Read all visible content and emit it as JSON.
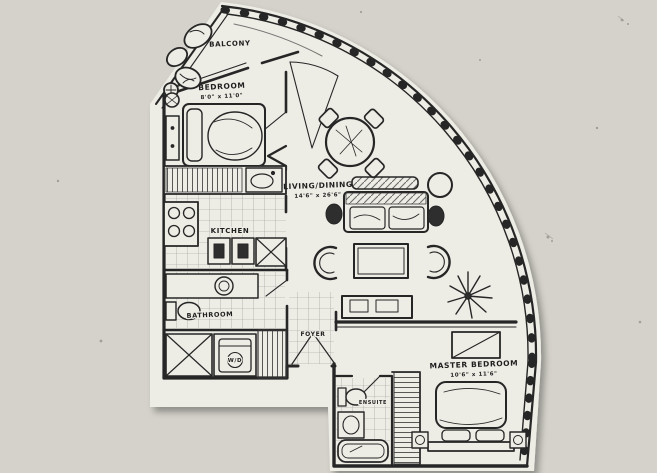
{
  "colors": {
    "background": "#d4d2ca",
    "paper": "#edece5",
    "ink": "#262626",
    "speck": "#77756c"
  },
  "plan": {
    "balcony_label": "BALCONY",
    "bedroom_label": "BEDROOM",
    "bedroom_dims": "8'0\" x 11'0\"",
    "living_label": "LIVING/DINING",
    "living_dims": "14'6\" x 26'6\"",
    "kitchen_label": "KITCHEN",
    "bathroom_label": "BATHROOM",
    "laundry_label": "W/D",
    "foyer_label": "FOYER",
    "master_label": "MASTER BEDROOM",
    "master_dims": "10'6\" x 11'6\"",
    "ensuite_label": "ENSUITE"
  }
}
